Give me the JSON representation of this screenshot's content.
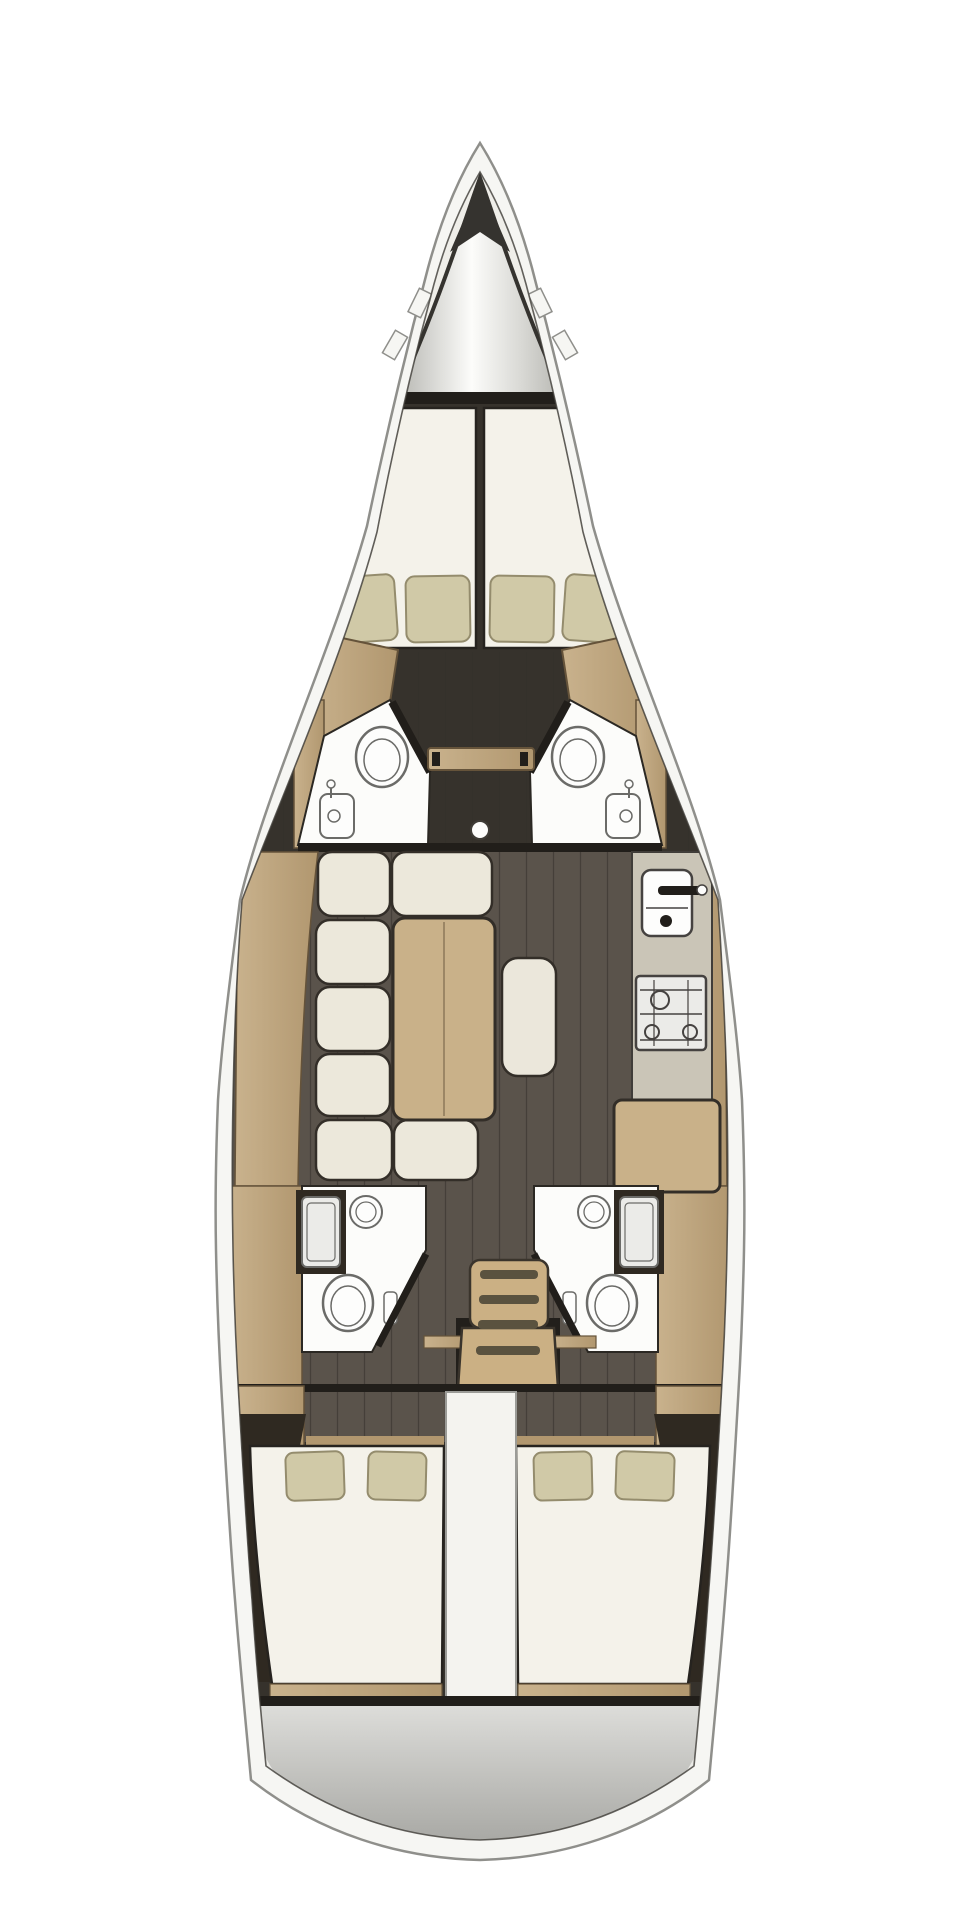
{
  "meta": {
    "description": "Top-down interior layout floor plan of a sailing yacht (no text labels in image)",
    "orientation": "bow at top, stern at bottom"
  },
  "palette": {
    "page_bg": "#ffffff",
    "hull_fill": "#f6f6f3",
    "hull_stroke": "#8f8f8b",
    "rim_fill": "#eaeae6",
    "inner_line": "#3f3c37",
    "bow_interior": "#efeee9",
    "anchor_edge": "#35332f",
    "anchor_dark": "#b7b7b2",
    "anchor_mid": "#d9d9d5",
    "anchor_light": "#fcfcfa",
    "bulkhead": "#211e1a",
    "fwd_base": "#36322c",
    "floor": "#5a534b",
    "floor_fwd": "#4f4942",
    "wood": "#c9b28d",
    "wood_dark": "#b1976f",
    "wood_stroke": "#65533a",
    "mattress": "#f4f2ea",
    "mattress_stroke": "#26231f",
    "pillow": "#d0c9a7",
    "pillow_stroke": "#948c6d",
    "bath": "#fcfcfa",
    "bath_stroke": "#2b2823",
    "fixture": "#6b6b68",
    "white_fixture": "#fdfdfc",
    "counter": "#cac5b7",
    "counter_stroke": "#403d39",
    "steel": "#ebebe8",
    "steel_stroke": "#454240",
    "table_wood": "#c9b189",
    "ottoman": "#ebe7db",
    "cushion": "#ece8db",
    "cushion_stroke": "#332e28",
    "wedge": "#2f2921",
    "engine": "#f4f3ef",
    "engine_stroke": "#9b9b97",
    "stairs": "#cbb084",
    "stair_slot": "#5a523f",
    "stairs_stroke": "#3a342c",
    "transom_light": "#dededb",
    "transom_dark": "#a9a9a5",
    "shadow": "#221f1b"
  },
  "rooms": [
    {
      "id": "anchor-locker",
      "name": "bow anchor locker"
    },
    {
      "id": "forward-cabin-port",
      "name": "forward V-berth cabin port",
      "items": [
        "mattress",
        "2 pillows",
        "wardrobe"
      ]
    },
    {
      "id": "forward-cabin-starboard",
      "name": "forward V-berth cabin starboard",
      "items": [
        "mattress",
        "2 pillows",
        "wardrobe"
      ]
    },
    {
      "id": "forward-head-port",
      "name": "forward bathroom port",
      "items": [
        "toilet",
        "sink",
        "door"
      ]
    },
    {
      "id": "forward-head-starboard",
      "name": "forward bathroom starboard",
      "items": [
        "toilet",
        "sink",
        "door"
      ]
    },
    {
      "id": "saloon",
      "name": "saloon",
      "items": [
        "U-shaped settee with 7 cushions",
        "dining table",
        "ottoman seat",
        "mast foot"
      ]
    },
    {
      "id": "galley",
      "name": "galley starboard",
      "items": [
        "counter",
        "sink with faucet",
        "gimbaled stove with oven"
      ]
    },
    {
      "id": "nav-station",
      "name": "chart table"
    },
    {
      "id": "aft-head-port",
      "name": "aft bathroom port",
      "items": [
        "shower pan",
        "round sink",
        "toilet",
        "door"
      ]
    },
    {
      "id": "aft-head-starboard",
      "name": "aft bathroom starboard",
      "items": [
        "shower pan",
        "round sink",
        "toilet",
        "door"
      ]
    },
    {
      "id": "companionway",
      "name": "companionway stairs",
      "items": [
        "4 treads"
      ]
    },
    {
      "id": "aft-cabin-port",
      "name": "aft double cabin port",
      "items": [
        "double berth",
        "2 pillows"
      ]
    },
    {
      "id": "aft-cabin-starboard",
      "name": "aft double cabin starboard",
      "items": [
        "double berth",
        "2 pillows"
      ]
    },
    {
      "id": "engine-compartment",
      "name": "engine compartment cover"
    },
    {
      "id": "transom",
      "name": "stern transom platform"
    }
  ],
  "counts": {
    "cabins": 4,
    "heads": 4,
    "pillows": 8,
    "companionway_steps": 4
  }
}
